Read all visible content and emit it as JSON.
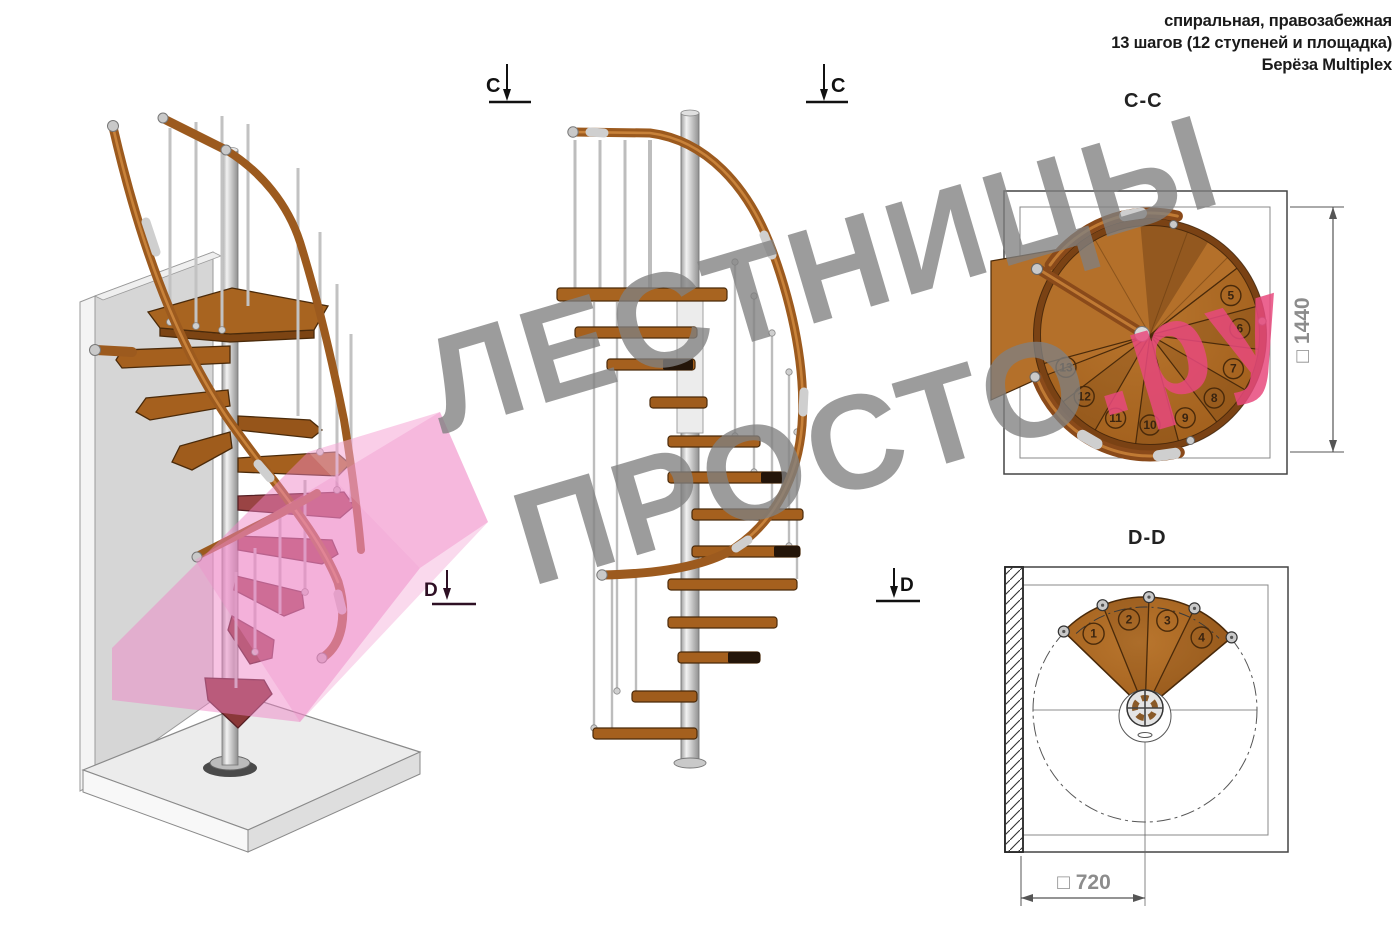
{
  "header": {
    "lines": [
      "спиральная, правозабежная",
      "13 шагов (12 ступеней и площадка)",
      "Берёза Multiplex"
    ]
  },
  "watermark": {
    "word1": "ЛЕСТНИЦЫ",
    "word2": "ПРОСТО",
    "suffix": ".ру"
  },
  "labels": {
    "section_cc": "C-C",
    "section_dd": "D-D",
    "dim_cc": "□ 1440",
    "dim_dd": "□ 720",
    "marker_c": "C",
    "marker_d": "D"
  },
  "plan_cc": {
    "steps": [
      "5",
      "6",
      "7",
      "8",
      "9",
      "10",
      "11",
      "12",
      "13"
    ]
  },
  "plan_dd": {
    "steps": [
      "1",
      "2",
      "3",
      "4"
    ]
  },
  "colors": {
    "wood": "#a9641c",
    "wood_dark": "#7c4413",
    "handrail": "#9c5a1e",
    "metal": "#d6d6d6",
    "cut_plane_pink": "#ee82c4",
    "cut_tread_maroon": "#9a4444",
    "watermark_gray": "#808080",
    "watermark_pink": "#e7497c",
    "dimension_text": "#8c8c8c",
    "ink": "#1a1a1a"
  }
}
